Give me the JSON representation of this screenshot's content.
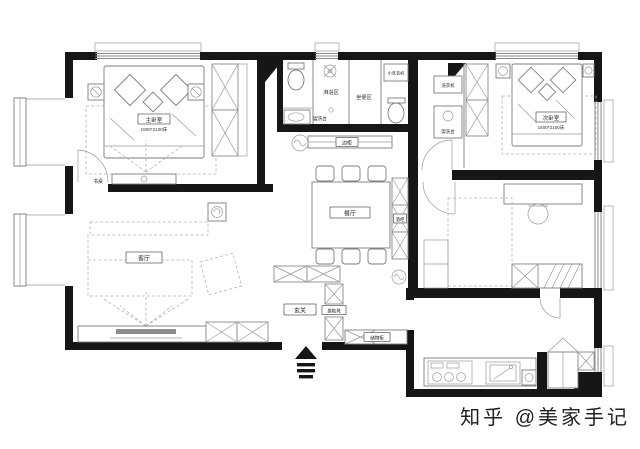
{
  "watermark": "知乎 @美家手记",
  "rooms": {
    "master_bedroom": {
      "name": "主卧室",
      "bed_size": "1900*2100床"
    },
    "secondary_bedroom": {
      "name": "次卧室",
      "bed_size": "1500*2100床"
    },
    "living_room": {
      "name": "客厅"
    },
    "dining_room": {
      "name": "餐厅"
    },
    "entry": {
      "name": "玄关"
    }
  },
  "labels": {
    "shower_zone": "淋浴区",
    "toilet_zone": "坐便区",
    "small_washer": "小洗衣机",
    "washer": "洗衣机",
    "vanity_bath": "盥洗台",
    "vanity_cloak": "盥洗台",
    "side_cabinet": "边柜",
    "wine_cabinet": "酒柜",
    "desk": "书桌",
    "shoe_bench": "换鞋凳",
    "storage_cabinet": "储物柜"
  },
  "colors": {
    "wall": "#161616",
    "furniture_line": "#8a8a8a",
    "watermark": "#c9c9c9"
  }
}
